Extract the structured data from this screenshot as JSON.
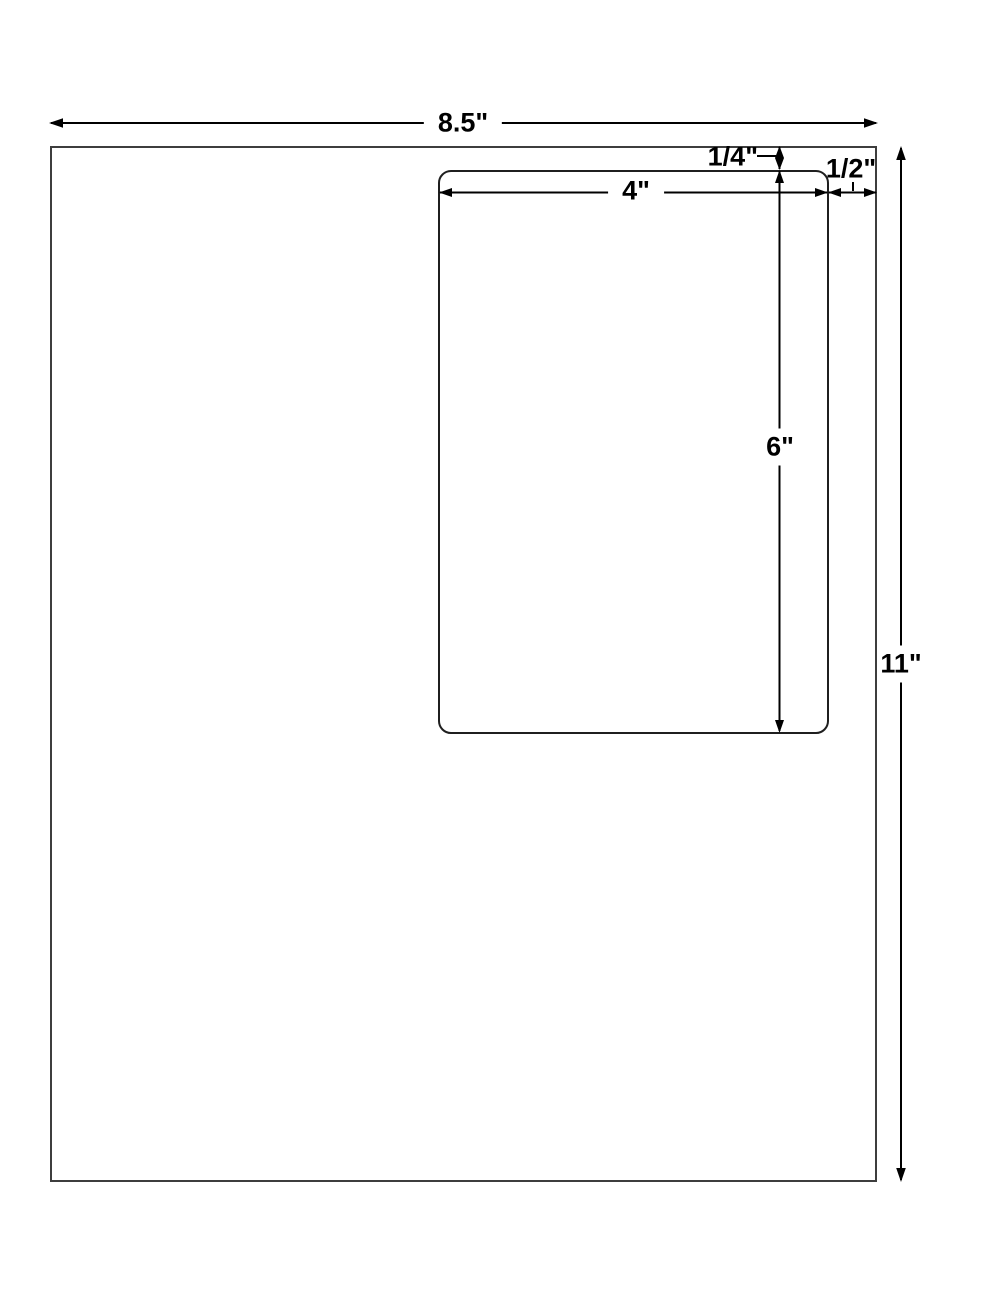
{
  "diagram": {
    "description": "Label sheet dimension diagram",
    "sheet": {
      "width_label": "8.5\"",
      "height_label": "11\""
    },
    "label_cell": {
      "width_label": "4\"",
      "height_label": "6\"",
      "top_margin_label": "1/4\"",
      "right_margin_label": "1/2\""
    },
    "colors": {
      "background": "#ffffff",
      "sheet_border": "#3d3d3d",
      "label_border": "#1f1f1f",
      "dimension_line": "#000000",
      "text": "#000000"
    }
  }
}
